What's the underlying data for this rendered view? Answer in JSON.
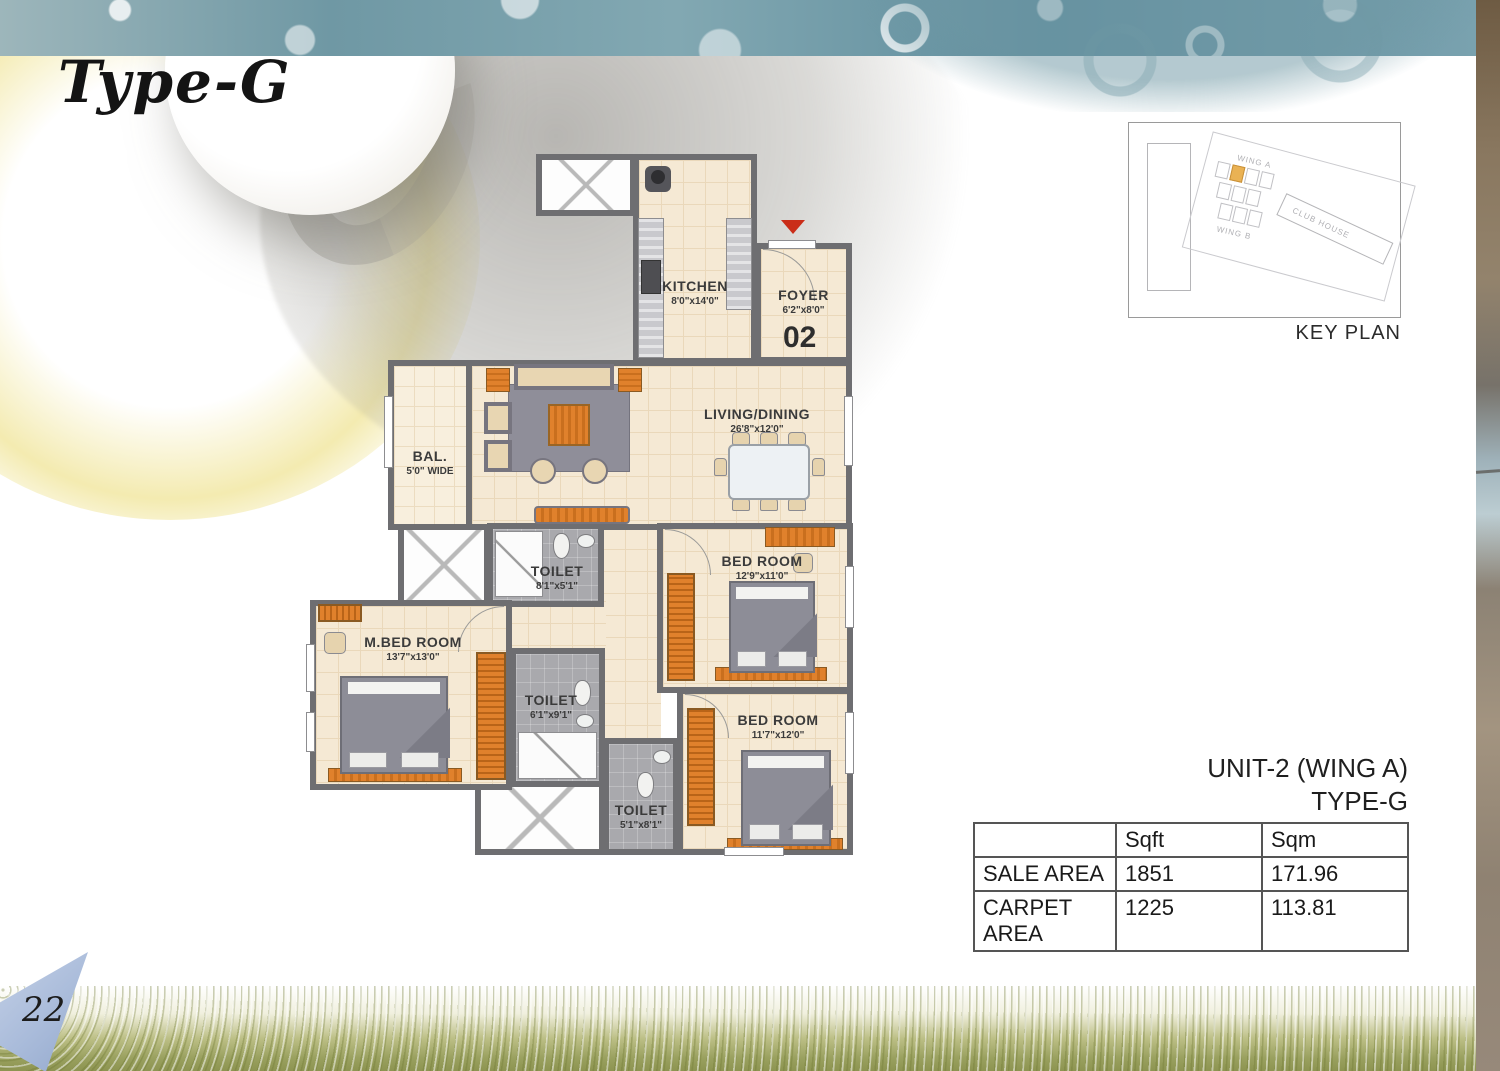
{
  "page": {
    "title": "Type-G",
    "page_number": "22"
  },
  "floor_plan": {
    "unit_number": "02",
    "rooms": [
      {
        "id": "kitchen",
        "name": "KITCHEN",
        "dims": "8'0\"x14'0\""
      },
      {
        "id": "foyer",
        "name": "FOYER",
        "dims": "6'2\"x8'0\""
      },
      {
        "id": "living",
        "name": "LIVING/DINING",
        "dims": "26'8\"x12'0\""
      },
      {
        "id": "balcony",
        "name": "BAL.",
        "dims": "5'0\" WIDE"
      },
      {
        "id": "toilet1",
        "name": "TOILET",
        "dims": "8'1\"x5'1\""
      },
      {
        "id": "bedroom1",
        "name": "BED ROOM",
        "dims": "12'9\"x11'0\""
      },
      {
        "id": "mbedroom",
        "name": "M.BED ROOM",
        "dims": "13'7\"x13'0\""
      },
      {
        "id": "toilet2",
        "name": "TOILET",
        "dims": "6'1\"x9'1\""
      },
      {
        "id": "bedroom2",
        "name": "BED ROOM",
        "dims": "11'7\"x12'0\""
      },
      {
        "id": "toilet3",
        "name": "TOILET",
        "dims": "5'1\"x8'1\""
      }
    ]
  },
  "key_plan": {
    "caption": "KEY PLAN",
    "wing_a_label": "WING A",
    "club_house_label": "CLUB HOUSE",
    "wing_b_label": "WING B",
    "highlight_color": "#eab254"
  },
  "unit_info": {
    "line1": "UNIT-2 (WING A)",
    "line2": "TYPE-G"
  },
  "area_table": {
    "headers": [
      "",
      "Sqft",
      "Sqm"
    ],
    "rows": [
      {
        "label": "SALE AREA",
        "sqft": "1851",
        "sqm": "171.96"
      },
      {
        "label": "CARPET AREA",
        "sqft": "1225",
        "sqm": "113.81"
      }
    ]
  },
  "colors": {
    "wall_gray": "#6e6e71",
    "floor_beige": "#f5e9d4",
    "accent_orange": "#e0812c",
    "entry_marker_red": "#ca2d18",
    "top_band_teal": "#6f98a4",
    "bottom_band_green": "#99a05e"
  }
}
